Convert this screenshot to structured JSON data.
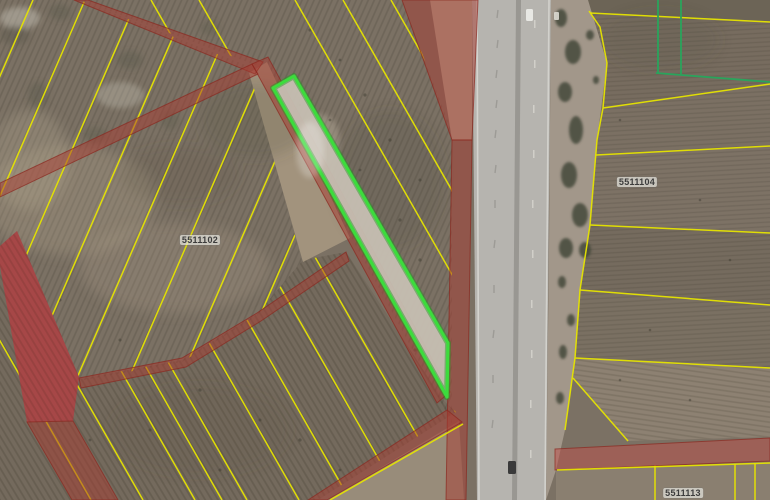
{
  "map": {
    "description": "satellite-cadastral-view",
    "parcel_labels": [
      {
        "id": "5511102",
        "x": 200,
        "y": 240
      },
      {
        "id": "5511104",
        "x": 637,
        "y": 182
      },
      {
        "id": "5511113",
        "x": 683,
        "y": 493
      }
    ],
    "colors": {
      "parcel_line": "#e6e400",
      "road_overlay": "#a83c32",
      "road_overlay_edge": "#8a2820",
      "selected_outline": "#3cdc3c",
      "green_boundary": "#2aa45c",
      "label_text": "#3c3c3c"
    }
  }
}
